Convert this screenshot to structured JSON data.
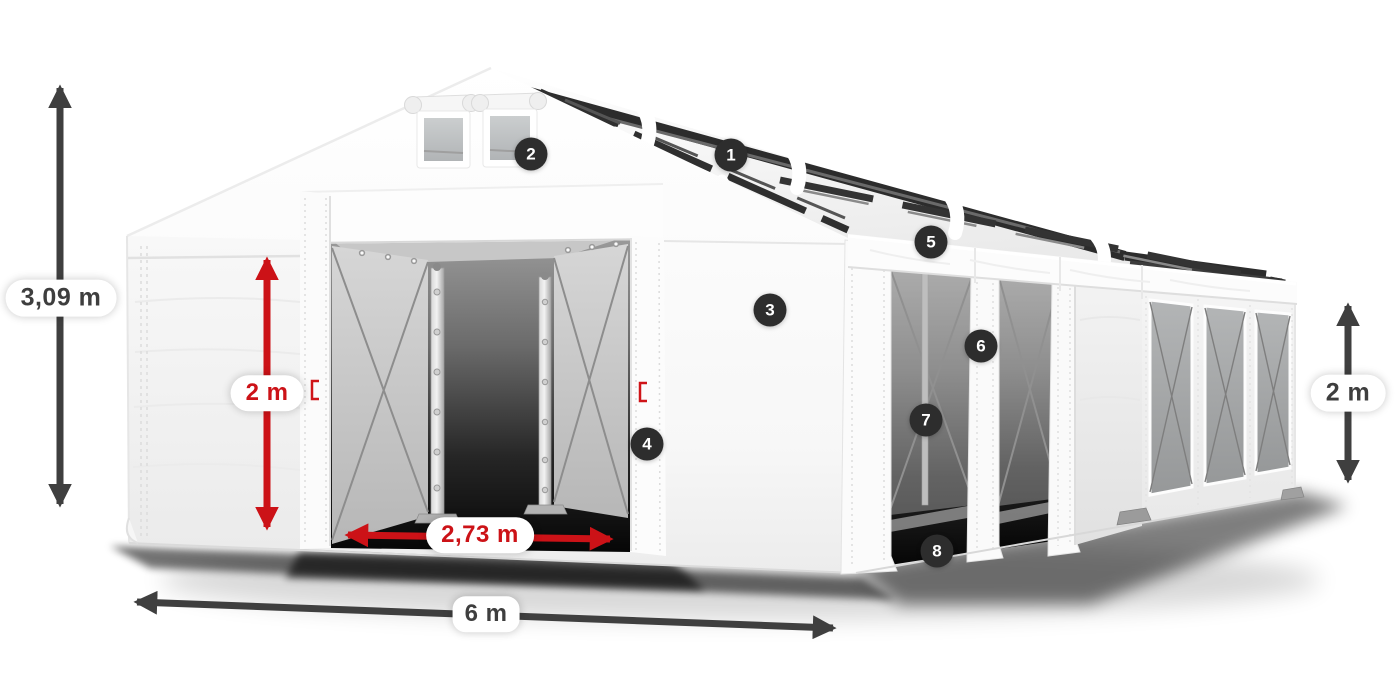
{
  "diagram": {
    "subject": "storage-tent-size-diagram",
    "dimensions": [
      {
        "id": "total-height",
        "label": "3,09 m",
        "style": "dark"
      },
      {
        "id": "entrance-height",
        "label": "2 m",
        "style": "red"
      },
      {
        "id": "entrance-width",
        "label": "2,73 m",
        "style": "red"
      },
      {
        "id": "total-width",
        "label": "6 m",
        "style": "dark"
      },
      {
        "id": "side-height",
        "label": "2 m",
        "style": "dark"
      }
    ],
    "callouts": [
      {
        "number": "1"
      },
      {
        "number": "2"
      },
      {
        "number": "3"
      },
      {
        "number": "4"
      },
      {
        "number": "5"
      },
      {
        "number": "6"
      },
      {
        "number": "7"
      },
      {
        "number": "8"
      }
    ],
    "colors": {
      "accent_red": "#cc1217",
      "annotation_dark": "#3f3f3f",
      "badge_background": "#2d2d2d",
      "badge_text": "#ffffff",
      "tent_white": "#fafafa"
    }
  }
}
